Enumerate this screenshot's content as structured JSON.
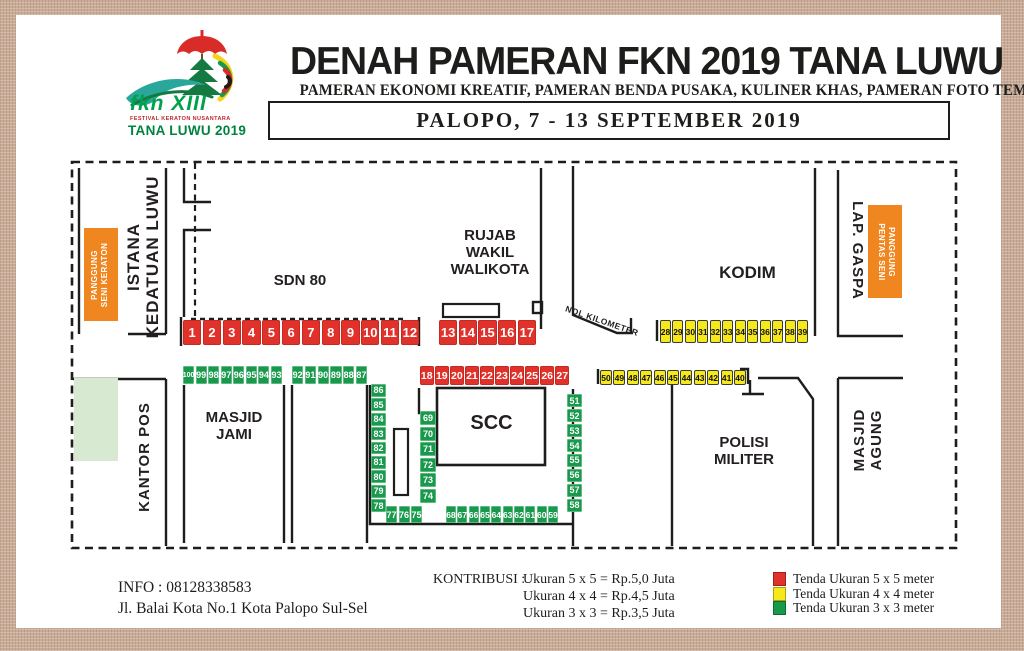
{
  "header": {
    "title": "DENAH PAMERAN FKN 2019 TANA LUWU",
    "subtitle": "PAMERAN EKONOMI KREATIF, PAMERAN BENDA PUSAKA, KULINER KHAS, PAMERAN FOTO TEMPO DOELOE",
    "date_line": "PALOPO, 7 - 13 SEPTEMBER 2019",
    "logo": {
      "line1": "fkn XIII",
      "line2": "FESTIVAL KERATON NUSANTARA",
      "line3": "TANA LUWU 2019"
    }
  },
  "map": {
    "labels": {
      "istana": "ISTANA\nKEDATUAN LUWU",
      "panggung_keraton": "PANGGUNG\nSENI KERATON",
      "sdn80": "SDN 80",
      "rujab": "RUJAB\nWAKIL\nWALIKOTA",
      "nol_kilometer": "NOL KILOMETER",
      "kodim": "KODIM",
      "lap_gaspa": "LAP. GASPA",
      "panggung_pentas": "PANGGUNG\nPENTAS SENI",
      "kantor_pos": "KANTOR POS",
      "masjid_jami": "MASJID\nJAMI",
      "scc": "SCC",
      "polisi_militer": "POLISI\nMILITER",
      "masjid_agung": "MASJID\nAGUNG"
    },
    "booths": {
      "sdn80_row": [
        "1",
        "2",
        "3",
        "4",
        "5",
        "6",
        "7",
        "8",
        "9",
        "10",
        "11",
        "12"
      ],
      "rujab_row": [
        "13",
        "14",
        "15",
        "16",
        "17"
      ],
      "scc_top_row": [
        "18",
        "19",
        "20",
        "21",
        "22",
        "23",
        "24",
        "25",
        "26",
        "27"
      ],
      "kodim_row": [
        "28",
        "29",
        "30",
        "31",
        "32",
        "33",
        "34",
        "35",
        "36",
        "37",
        "38",
        "39"
      ],
      "polmil_row": [
        "50",
        "49",
        "48",
        "47",
        "46",
        "45",
        "44",
        "43",
        "42",
        "41",
        "40"
      ],
      "jami_row": [
        "100",
        "99",
        "98",
        "97",
        "96",
        "95",
        "94",
        "93"
      ],
      "lot2_row": [
        "92",
        "91",
        "90",
        "89",
        "88",
        "87"
      ],
      "strip_left": [
        "86",
        "85",
        "84",
        "83",
        "82",
        "81",
        "80",
        "79",
        "78"
      ],
      "strip_inner": [
        "69",
        "70",
        "71",
        "72",
        "73",
        "74"
      ],
      "strip_right": [
        "51",
        "52",
        "53",
        "54",
        "55",
        "56",
        "57",
        "58"
      ],
      "bottom_left_row": [
        "77",
        "76",
        "75"
      ],
      "bottom_right_row": [
        "68",
        "67",
        "66",
        "65",
        "64",
        "63",
        "62",
        "61",
        "60",
        "59"
      ]
    }
  },
  "footer": {
    "info_line1": "INFO : 08128338583",
    "info_line2": "Jl. Balai Kota No.1 Kota Palopo Sul-Sel",
    "kontribusi_label": "KONTRIBUSI :",
    "kontribusi_items": [
      "Ukuran 5 x 5 = Rp.5,0 Juta",
      "Ukuran 4 x 4 = Rp.4,5 Juta",
      "Ukuran 3 x 3 = Rp.3,5 Juta"
    ],
    "legend": [
      {
        "color": "#e0312a",
        "label": "Tenda Ukuran 5 x 5 meter"
      },
      {
        "color": "#f5e91c",
        "label": "Tenda Ukuran 4 x 4 meter"
      },
      {
        "color": "#18994b",
        "label": "Tenda Ukuran 3 x 3 meter"
      }
    ]
  },
  "colors": {
    "red": "#e0312a",
    "yellow": "#f5e91c",
    "green": "#18994b",
    "orange": "#f0861f",
    "light_green": "#d8e9d2",
    "frame": "#c9ab97",
    "ink": "#1d1d1b"
  }
}
